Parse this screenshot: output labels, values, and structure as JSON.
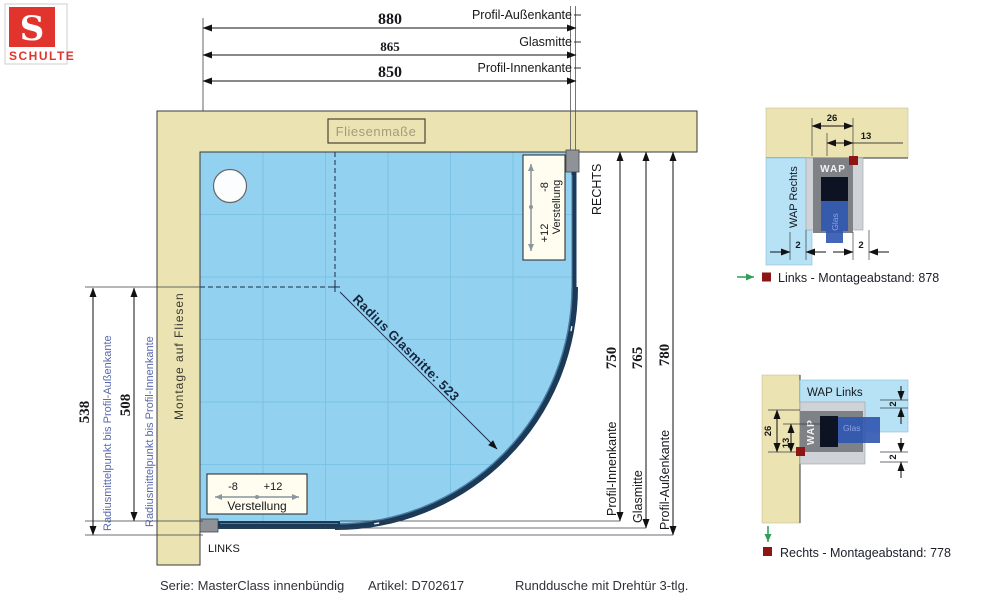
{
  "logo": {
    "letter": "S",
    "name": "SCHULTE"
  },
  "dims_top": {
    "outer": {
      "value": "880",
      "label": "Profil-Außenkante"
    },
    "glass": {
      "value": "865",
      "label": "Glasmitte"
    },
    "inner": {
      "value": "850",
      "label": "Profil-Innenkante"
    }
  },
  "dims_right": {
    "inner": {
      "value": "750",
      "label": "Profil-Innenkante"
    },
    "glass": {
      "value": "765",
      "label": "Glasmitte"
    },
    "outer": {
      "value": "780",
      "label": "Profil-Außenkante"
    },
    "side": "RECHTS"
  },
  "dims_left": {
    "outer": {
      "value": "538",
      "label": "Radiusmittelpunkt bis Profil-Außenkante"
    },
    "inner": {
      "value": "508",
      "label": "Radiusmittelpunkt bis Profil-Innenkante"
    },
    "side": "LINKS"
  },
  "wall": {
    "tile_note": "Fliesenmaße",
    "mount_note": "Montage auf Fliesen"
  },
  "glass_radius_label": "Radius Glasmitte: 523",
  "adjust_right": {
    "minus": "-8",
    "plus": "+12",
    "label": "Verstellung"
  },
  "adjust_bottom": {
    "minus": "-8",
    "plus": "+12",
    "label": "Verstellung"
  },
  "detail_top": {
    "zone": "WAP Rechts",
    "profile": "WAP",
    "glass": "Glas",
    "dim_width": "26",
    "dim_half": "13",
    "dim_gap_left": "2",
    "dim_gap_right": "2",
    "caption": "Links - Montageabstand: 878"
  },
  "detail_bottom": {
    "zone": "WAP Links",
    "profile": "WAP",
    "glass": "Glas",
    "dim_width": "26",
    "dim_half": "13",
    "dim_gap_top": "2",
    "dim_gap_bottom": "2",
    "caption": "Rechts - Montageabstand: 778"
  },
  "footer": {
    "series": "Serie: MasterClass innenbündig",
    "article": "Artikel: D702617",
    "product": "Runddusche mit Drehtür 3-tlg."
  },
  "colors": {
    "wall": "#ece3b2",
    "tray": "#92d1f0",
    "profile": "#1b3a58",
    "accent_red": "#8e1515",
    "accent_green": "#2f9e57",
    "brand_red": "#e0342c",
    "dim_label_blue": "#5868ad"
  }
}
